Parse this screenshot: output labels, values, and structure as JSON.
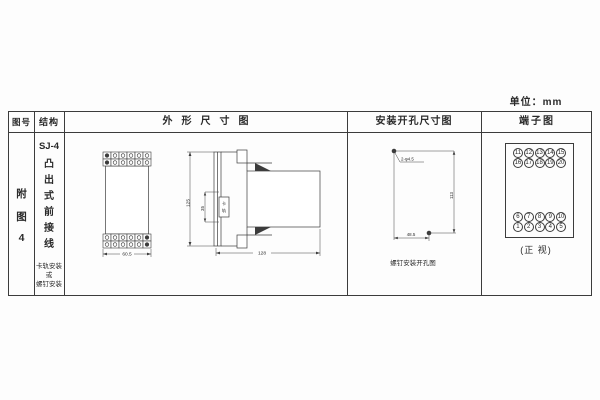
{
  "unit_label": "单位：mm",
  "table": {
    "headers": {
      "figure_no": "图号",
      "structure": "结构",
      "outline": "外形尺寸图",
      "mounting": "安装开孔尺寸图",
      "terminal": "端子图"
    },
    "figure_no_chars": [
      "附",
      "图",
      "4"
    ],
    "structure": {
      "model": "SJ-4",
      "type_chars": [
        "凸",
        "出",
        "式",
        "前",
        "接",
        "线"
      ],
      "mount_note_lines": [
        "卡轨安装",
        "或",
        "螺钉安装"
      ]
    }
  },
  "outline_drawing": {
    "front_width_mm": "60.5",
    "height_mm": "125",
    "rail_offset_mm": "35",
    "rail_label_chars": [
      "卡",
      "轨"
    ],
    "depth_mm": "128"
  },
  "mounting_drawing": {
    "holes_label": "2-φ4.5",
    "vertical_spacing_mm": "113",
    "horizontal_spacing_mm": "48.5",
    "caption": "螺钉安装开孔图"
  },
  "terminal_diagram": {
    "top_group_rows": [
      [
        "11",
        "12",
        "13",
        "14",
        "15"
      ],
      [
        "16",
        "17",
        "18",
        "19",
        "20"
      ]
    ],
    "bottom_group_rows": [
      [
        "6",
        "7",
        "8",
        "9",
        "10"
      ],
      [
        "1",
        "2",
        "3",
        "4",
        "5"
      ]
    ],
    "caption": "(正 视)"
  },
  "colors": {
    "line": "#3c3c3c",
    "paper": "#fdfdfd"
  }
}
